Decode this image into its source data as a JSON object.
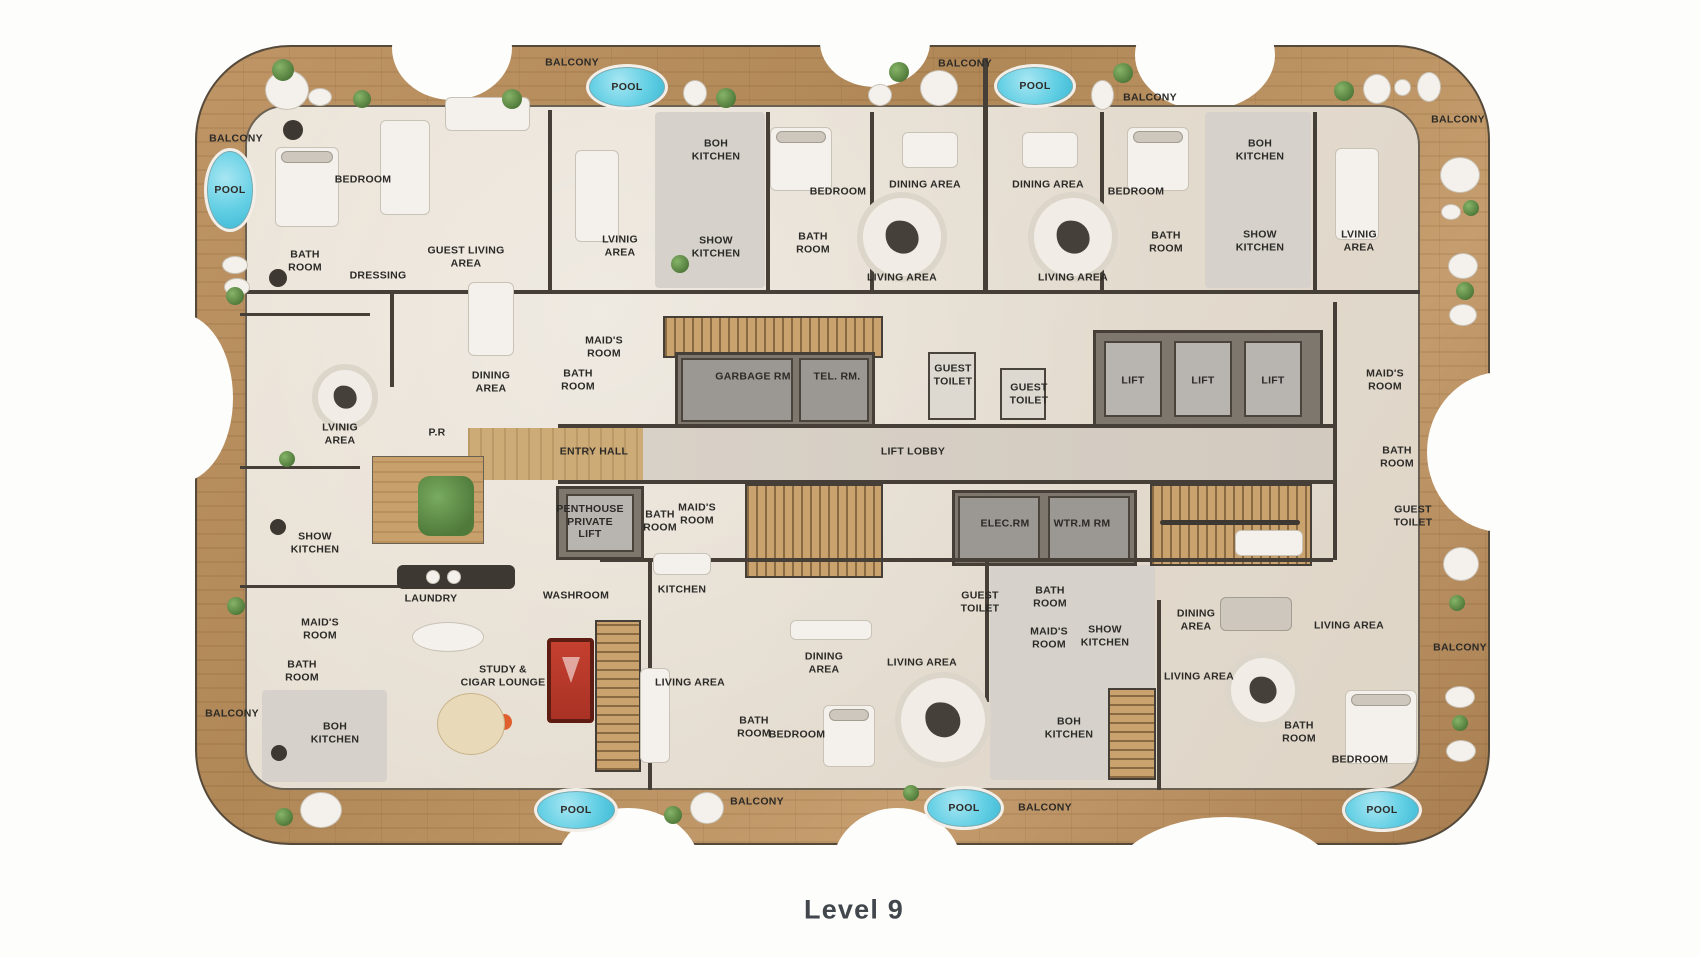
{
  "title": "Level 9",
  "colors": {
    "wood": "#b48a5c",
    "floor": "#e6ded2",
    "wall": "#453f38",
    "pool_blue": "#62cfe4",
    "pool_table_red": "#c4402f",
    "label_text": "#2b2a27",
    "title_text": "#41474c"
  },
  "floor_plan": {
    "labels": [
      {
        "text": "BALCONY",
        "x": 236,
        "y": 139
      },
      {
        "text": "BEDROOM",
        "x": 363,
        "y": 180
      },
      {
        "text": "BATH\nROOM",
        "x": 305,
        "y": 261
      },
      {
        "text": "DRESSING",
        "x": 378,
        "y": 276
      },
      {
        "text": "GUEST LIVING\nAREA",
        "x": 466,
        "y": 257
      },
      {
        "text": "BALCONY",
        "x": 572,
        "y": 63
      },
      {
        "text": "BOH\nKITCHEN",
        "x": 716,
        "y": 150
      },
      {
        "text": "LVINIG\nAREA",
        "x": 620,
        "y": 246
      },
      {
        "text": "SHOW\nKITCHEN",
        "x": 716,
        "y": 247
      },
      {
        "text": "BEDROOM",
        "x": 838,
        "y": 192
      },
      {
        "text": "BATH\nROOM",
        "x": 813,
        "y": 243
      },
      {
        "text": "BALCONY",
        "x": 965,
        "y": 64
      },
      {
        "text": "DINING AREA",
        "x": 925,
        "y": 185
      },
      {
        "text": "DINING AREA",
        "x": 1048,
        "y": 185
      },
      {
        "text": "LIVING AREA",
        "x": 902,
        "y": 278
      },
      {
        "text": "LIVING AREA",
        "x": 1073,
        "y": 278
      },
      {
        "text": "BEDROOM",
        "x": 1136,
        "y": 192
      },
      {
        "text": "BATH\nROOM",
        "x": 1166,
        "y": 242
      },
      {
        "text": "BALCONY",
        "x": 1150,
        "y": 98
      },
      {
        "text": "BOH\nKITCHEN",
        "x": 1260,
        "y": 150
      },
      {
        "text": "SHOW\nKITCHEN",
        "x": 1260,
        "y": 241
      },
      {
        "text": "LVINIG\nAREA",
        "x": 1359,
        "y": 241
      },
      {
        "text": "BALCONY",
        "x": 1458,
        "y": 120
      },
      {
        "text": "LVINIG\nAREA",
        "x": 340,
        "y": 434
      },
      {
        "text": "DINING\nAREA",
        "x": 491,
        "y": 382
      },
      {
        "text": "P.R",
        "x": 437,
        "y": 433
      },
      {
        "text": "MAID'S\nROOM",
        "x": 604,
        "y": 347
      },
      {
        "text": "BATH\nROOM",
        "x": 578,
        "y": 380
      },
      {
        "text": "GARBAGE RM",
        "x": 753,
        "y": 377
      },
      {
        "text": "TEL. RM.",
        "x": 837,
        "y": 377
      },
      {
        "text": "GUEST\nTOILET",
        "x": 953,
        "y": 375
      },
      {
        "text": "GUEST\nTOILET",
        "x": 1029,
        "y": 394
      },
      {
        "text": "LIFT",
        "x": 1133,
        "y": 381
      },
      {
        "text": "LIFT",
        "x": 1203,
        "y": 381
      },
      {
        "text": "LIFT",
        "x": 1273,
        "y": 381
      },
      {
        "text": "MAID'S\nROOM",
        "x": 1385,
        "y": 380
      },
      {
        "text": "BATH\nROOM",
        "x": 1397,
        "y": 457
      },
      {
        "text": "ENTRY HALL",
        "x": 594,
        "y": 452
      },
      {
        "text": "LIFT LOBBY",
        "x": 913,
        "y": 452
      },
      {
        "text": "PENTHOUSE\nPRIVATE\nLIFT",
        "x": 590,
        "y": 522
      },
      {
        "text": "BATH\nROOM",
        "x": 660,
        "y": 521
      },
      {
        "text": "MAID'S\nROOM",
        "x": 697,
        "y": 514
      },
      {
        "text": "ELEC.RM",
        "x": 1005,
        "y": 524
      },
      {
        "text": "WTR.M RM",
        "x": 1082,
        "y": 524
      },
      {
        "text": "GUEST\nTOILET",
        "x": 1413,
        "y": 516
      },
      {
        "text": "SHOW\nKITCHEN",
        "x": 315,
        "y": 543
      },
      {
        "text": "MAID'S\nROOM",
        "x": 320,
        "y": 629
      },
      {
        "text": "BATH\nROOM",
        "x": 302,
        "y": 671
      },
      {
        "text": "BOH\nKITCHEN",
        "x": 335,
        "y": 733
      },
      {
        "text": "BALCONY",
        "x": 232,
        "y": 714
      },
      {
        "text": "LAUNDRY",
        "x": 431,
        "y": 599
      },
      {
        "text": "WASHROOM",
        "x": 576,
        "y": 596
      },
      {
        "text": "STUDY &\nCIGAR LOUNGE",
        "x": 503,
        "y": 676
      },
      {
        "text": "KITCHEN",
        "x": 682,
        "y": 590
      },
      {
        "text": "LIVING AREA",
        "x": 690,
        "y": 683
      },
      {
        "text": "BATH\nROOM",
        "x": 754,
        "y": 727
      },
      {
        "text": "BEDROOM",
        "x": 797,
        "y": 735
      },
      {
        "text": "DINING\nAREA",
        "x": 824,
        "y": 663
      },
      {
        "text": "LIVING AREA",
        "x": 922,
        "y": 663
      },
      {
        "text": "GUEST\nTOILET",
        "x": 980,
        "y": 602
      },
      {
        "text": "BATH\nROOM",
        "x": 1050,
        "y": 597
      },
      {
        "text": "MAID'S\nROOM",
        "x": 1049,
        "y": 638
      },
      {
        "text": "SHOW\nKITCHEN",
        "x": 1105,
        "y": 636
      },
      {
        "text": "BOH\nKITCHEN",
        "x": 1069,
        "y": 728
      },
      {
        "text": "DINING\nAREA",
        "x": 1196,
        "y": 620
      },
      {
        "text": "LIVING AREA",
        "x": 1199,
        "y": 677
      },
      {
        "text": "LIVING AREA",
        "x": 1349,
        "y": 626
      },
      {
        "text": "BALCONY",
        "x": 757,
        "y": 802
      },
      {
        "text": "BALCONY",
        "x": 1045,
        "y": 808
      },
      {
        "text": "BALCONY",
        "x": 1460,
        "y": 648
      },
      {
        "text": "BATH\nROOM",
        "x": 1299,
        "y": 732
      },
      {
        "text": "BEDROOM",
        "x": 1360,
        "y": 760
      }
    ],
    "pools": [
      {
        "label": "POOL",
        "x": 230,
        "y": 190,
        "rx": 26,
        "ry": 42
      },
      {
        "label": "POOL",
        "x": 627,
        "y": 87,
        "rx": 41,
        "ry": 23
      },
      {
        "label": "POOL",
        "x": 1035,
        "y": 86,
        "rx": 41,
        "ry": 22
      },
      {
        "label": "POOL",
        "x": 576,
        "y": 810,
        "rx": 42,
        "ry": 22
      },
      {
        "label": "POOL",
        "x": 964,
        "y": 808,
        "rx": 40,
        "ry": 22
      },
      {
        "label": "POOL",
        "x": 1382,
        "y": 810,
        "rx": 40,
        "ry": 22
      }
    ]
  }
}
